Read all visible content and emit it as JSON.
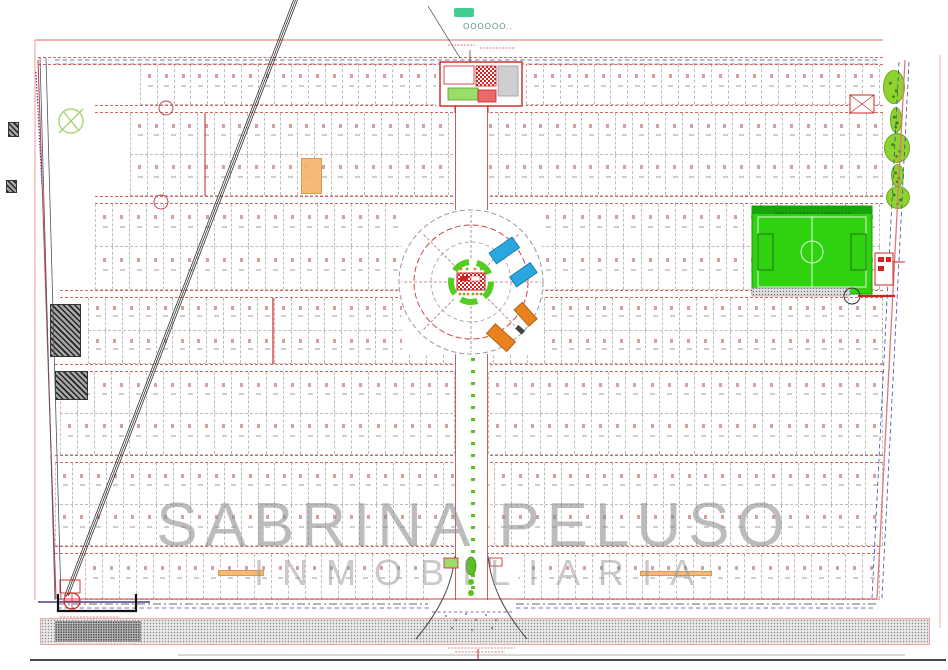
{
  "watermark": {
    "line1": "SABRINA PELUSO",
    "line2": "INMOBILIARIA"
  },
  "logo": {
    "mark": "OOOOOO",
    "suffix": ".."
  },
  "colors": {
    "boundary_pink": "#ef9a9a",
    "line_red": "#cc4444",
    "line_blue": "#3b4fa0",
    "field_green": "#2fd20f",
    "field_dark_green": "#17a30a",
    "tree_green": "#8ed32e",
    "pool_blue": "#2aa7e0",
    "awning_orange": "#e8821e",
    "median_green": "#5bbf21",
    "watermark_gray": "#8f8f8f",
    "lot_highlight_orange": "#f5b26b",
    "hatch_dark": "#2a2a2a",
    "road_stipple_gray": "#8a8a8a",
    "logo_teal": "#3ecf8e"
  },
  "plan": {
    "bands": [
      {
        "x": 140,
        "y": 64,
        "w": 740,
        "h": 41,
        "cols": 44
      },
      {
        "x": 130,
        "y": 113,
        "w": 753,
        "h": 42,
        "cols": 45
      },
      {
        "x": 130,
        "y": 155,
        "w": 753,
        "h": 41,
        "cols": 45
      },
      {
        "x": 95,
        "y": 204,
        "w": 785,
        "h": 43,
        "cols": 46
      },
      {
        "x": 95,
        "y": 247,
        "w": 785,
        "h": 43,
        "cols": 46
      },
      {
        "x": 88,
        "y": 298,
        "w": 795,
        "h": 33,
        "cols": 47
      },
      {
        "x": 88,
        "y": 331,
        "w": 795,
        "h": 33,
        "cols": 47
      },
      {
        "x": 60,
        "y": 372,
        "w": 823,
        "h": 42,
        "cols": 48
      },
      {
        "x": 60,
        "y": 414,
        "w": 823,
        "h": 41,
        "cols": 48
      },
      {
        "x": 55,
        "y": 463,
        "w": 828,
        "h": 42,
        "cols": 49
      },
      {
        "x": 55,
        "y": 505,
        "w": 828,
        "h": 41,
        "cols": 49
      },
      {
        "x": 85,
        "y": 554,
        "w": 795,
        "h": 46,
        "cols": 47
      }
    ],
    "streets": [
      {
        "x": 38,
        "y": 57,
        "w": 845
      },
      {
        "x": 95,
        "y": 105,
        "w": 788
      },
      {
        "x": 95,
        "y": 196,
        "w": 788
      },
      {
        "x": 60,
        "y": 290,
        "w": 823
      },
      {
        "x": 55,
        "y": 364,
        "w": 828
      },
      {
        "x": 55,
        "y": 455,
        "w": 828
      },
      {
        "x": 55,
        "y": 546,
        "w": 825
      }
    ]
  }
}
